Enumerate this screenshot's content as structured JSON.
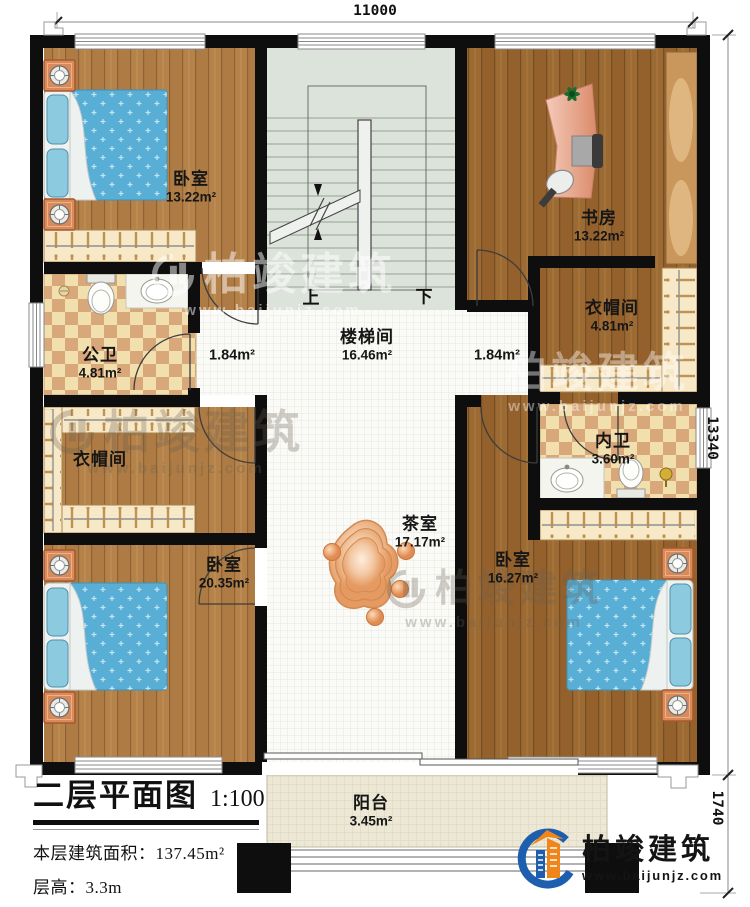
{
  "dimensions": {
    "top": "11000",
    "right": "13340",
    "bottom_right": "1740"
  },
  "rooms": {
    "bedroom_top_left": {
      "name": "卧室",
      "area": "13.22m²"
    },
    "study": {
      "name": "书房",
      "area": "13.22m²"
    },
    "public_bathroom": {
      "name": "公卫",
      "area": "4.81m²"
    },
    "corridor_left": {
      "area": "1.84m²"
    },
    "stair_hall": {
      "name": "楼梯间",
      "area": "16.46m²"
    },
    "corridor_right": {
      "area": "1.84m²"
    },
    "cloakroom_right": {
      "name": "衣帽间",
      "area": "4.81m²"
    },
    "inner_bathroom": {
      "name": "内卫",
      "area": "3.60m²"
    },
    "cloakroom_left": {
      "name": "衣帽间"
    },
    "bedroom_bottom_left": {
      "name": "卧室",
      "area": "20.35m²"
    },
    "tea_room": {
      "name": "茶室",
      "area": "17.17m²"
    },
    "bedroom_bottom_right": {
      "name": "卧室",
      "area": "16.27m²"
    },
    "balcony": {
      "name": "阳台",
      "area": "3.45m²"
    }
  },
  "stairs": {
    "up_label": "上",
    "down_label": "下"
  },
  "title_block": {
    "title": "二层平面图",
    "scale": "1:100",
    "floor_area_label": "本层建筑面积：",
    "floor_area_value": "137.45m²",
    "floor_height_label": "层高：",
    "floor_height_value": "3.3m"
  },
  "brand": {
    "name": "柏竣建筑",
    "website": "www.baijunjz.com"
  },
  "watermark": {
    "name": "柏竣建筑",
    "website": "www.baijunjz.com"
  },
  "colors": {
    "wall": "#0e0e0e",
    "wood_light": "#b5834a",
    "wood_dark": "#9c6a33",
    "bed_blue": "#58aed4",
    "tile_cream": "#f2dfae",
    "tile_tan": "#d8a87a",
    "accent_orange": "#f08519",
    "brand_blue": "#1d5fae"
  }
}
